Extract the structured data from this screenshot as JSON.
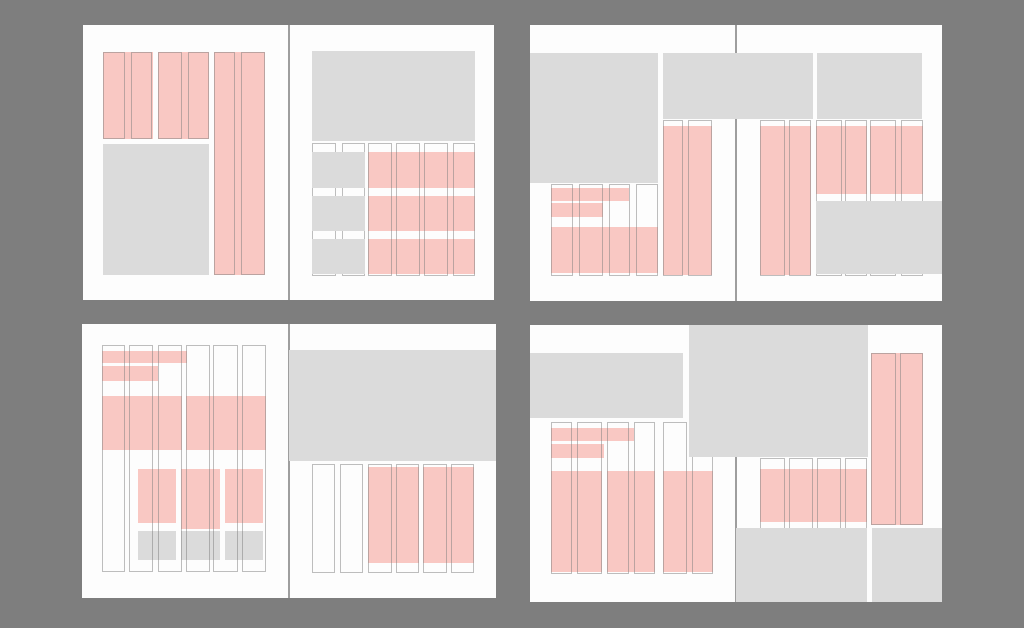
{
  "canvas": {
    "width": 1024,
    "height": 628,
    "background": "#7e7e7e"
  },
  "palette": {
    "page_white": "#fdfdfd",
    "text_block_pink": "#f9c8c3",
    "image_block_gray": "#dbdbdb",
    "column_guide_line": "rgba(125,125,125,0.5)",
    "fold_line_gray": "#7d7d7d"
  },
  "legend": {
    "pink_blocks": "text-column placeholders",
    "gray_blocks": "image placeholders",
    "outlined_columns": "grid column guides"
  },
  "spreads": [
    {
      "name": "spread-top-left",
      "x": 83,
      "y": 25,
      "w": 411,
      "h": 275,
      "fold_x": 205.5,
      "pages": [
        {
          "name": "page-left",
          "x": 0,
          "w": 205.5
        },
        {
          "name": "page-right",
          "x": 205.5,
          "w": 205.5
        }
      ],
      "pinks": [
        {
          "x": 20,
          "y": 26.5,
          "w": 49.5,
          "h": 87.5
        },
        {
          "x": 75,
          "y": 26.5,
          "w": 50.7,
          "h": 87.5
        },
        {
          "x": 130.7,
          "y": 26.5,
          "w": 51.6,
          "h": 223.2
        },
        {
          "x": 285.3,
          "y": 127,
          "w": 106.7,
          "h": 36
        },
        {
          "x": 285.3,
          "y": 171.3,
          "w": 106.7,
          "h": 35
        },
        {
          "x": 285.3,
          "y": 213.7,
          "w": 106.7,
          "h": 35
        }
      ],
      "grays_under": [],
      "guides": [
        {
          "x": 20,
          "y": 26.5,
          "w": 22.3,
          "h": 87.5
        },
        {
          "x": 48.3,
          "y": 26.5,
          "w": 21.2,
          "h": 87.5
        },
        {
          "x": 75,
          "y": 26.5,
          "w": 23.7,
          "h": 87.5
        },
        {
          "x": 104.7,
          "y": 26.5,
          "w": 21,
          "h": 87.5
        },
        {
          "x": 130.7,
          "y": 26.5,
          "w": 21.6,
          "h": 223.2
        },
        {
          "x": 158,
          "y": 26.5,
          "w": 24.3,
          "h": 223.2
        },
        {
          "x": 228.7,
          "y": 118,
          "w": 24.3,
          "h": 133
        },
        {
          "x": 258.7,
          "y": 118,
          "w": 23.3,
          "h": 133
        },
        {
          "x": 285.3,
          "y": 118,
          "w": 23.4,
          "h": 133
        },
        {
          "x": 313,
          "y": 118,
          "w": 24,
          "h": 133
        },
        {
          "x": 341.3,
          "y": 118,
          "w": 24,
          "h": 133
        },
        {
          "x": 369.7,
          "y": 118,
          "w": 22.3,
          "h": 133
        }
      ],
      "grays": [
        {
          "x": 20,
          "y": 119,
          "w": 105.7,
          "h": 130.7
        },
        {
          "x": 228.7,
          "y": 26.3,
          "w": 163.3,
          "h": 90
        },
        {
          "x": 228.7,
          "y": 127,
          "w": 53.3,
          "h": 36
        },
        {
          "x": 228.7,
          "y": 171.3,
          "w": 53.3,
          "h": 35
        },
        {
          "x": 228.7,
          "y": 213.7,
          "w": 53.3,
          "h": 35
        }
      ]
    },
    {
      "name": "spread-top-right",
      "x": 530,
      "y": 25,
      "w": 412,
      "h": 276,
      "fold_x": 206.3,
      "pages": [
        {
          "name": "page-left",
          "x": 0,
          "w": 206.3
        },
        {
          "name": "page-right",
          "x": 206.3,
          "w": 205.7
        }
      ],
      "pinks": [
        {
          "x": 21,
          "y": 163.3,
          "w": 78,
          "h": 12.7
        },
        {
          "x": 21,
          "y": 178.3,
          "w": 51.7,
          "h": 13.4
        },
        {
          "x": 21,
          "y": 201.7,
          "w": 107,
          "h": 46.6
        },
        {
          "x": 132.7,
          "y": 100.7,
          "w": 49,
          "h": 149
        },
        {
          "x": 230,
          "y": 100.7,
          "w": 51,
          "h": 149
        },
        {
          "x": 286,
          "y": 100.7,
          "w": 50.7,
          "h": 68
        },
        {
          "x": 340,
          "y": 100.7,
          "w": 53.3,
          "h": 68
        }
      ],
      "grays_under": [],
      "guides": [
        {
          "x": 21,
          "y": 158.5,
          "w": 22.3,
          "h": 92.5
        },
        {
          "x": 49.3,
          "y": 158.5,
          "w": 23.4,
          "h": 92.5
        },
        {
          "x": 79,
          "y": 158.5,
          "w": 21.3,
          "h": 92.5
        },
        {
          "x": 106,
          "y": 158.5,
          "w": 22,
          "h": 92.5
        },
        {
          "x": 132.7,
          "y": 95,
          "w": 20,
          "h": 155.5
        },
        {
          "x": 158.3,
          "y": 95,
          "w": 23.4,
          "h": 155.5
        },
        {
          "x": 230,
          "y": 95,
          "w": 25,
          "h": 155.5
        },
        {
          "x": 259.3,
          "y": 95,
          "w": 21.7,
          "h": 155.5
        },
        {
          "x": 286,
          "y": 95,
          "w": 25.7,
          "h": 155.5
        },
        {
          "x": 315,
          "y": 95,
          "w": 21.7,
          "h": 155.5
        },
        {
          "x": 340,
          "y": 95,
          "w": 26,
          "h": 155.5
        },
        {
          "x": 370.7,
          "y": 95,
          "w": 22.6,
          "h": 155.5
        }
      ],
      "grays": [
        {
          "x": 0,
          "y": 27.7,
          "w": 128,
          "h": 130.6
        },
        {
          "x": 132.7,
          "y": 27.7,
          "w": 150,
          "h": 66.6
        },
        {
          "x": 286.7,
          "y": 27.7,
          "w": 105.6,
          "h": 66.6
        },
        {
          "x": 286,
          "y": 176,
          "w": 126,
          "h": 73.3
        }
      ]
    },
    {
      "name": "spread-bottom-left",
      "x": 82,
      "y": 324,
      "w": 414,
      "h": 274,
      "fold_x": 206.5,
      "pages": [
        {
          "name": "page-left",
          "x": 0,
          "w": 206.5
        },
        {
          "name": "page-right",
          "x": 206.5,
          "w": 207.5
        }
      ],
      "pinks": [
        {
          "x": 20.3,
          "y": 26.7,
          "w": 84.4,
          "h": 12.6
        },
        {
          "x": 20.3,
          "y": 42,
          "w": 56,
          "h": 14.7
        },
        {
          "x": 20.3,
          "y": 72,
          "w": 79.4,
          "h": 54
        },
        {
          "x": 104,
          "y": 72,
          "w": 79.7,
          "h": 54
        },
        {
          "x": 56,
          "y": 144.5,
          "w": 38,
          "h": 54.5
        },
        {
          "x": 99,
          "y": 144.5,
          "w": 38.5,
          "h": 60
        },
        {
          "x": 143,
          "y": 144.5,
          "w": 38.3,
          "h": 54.5
        },
        {
          "x": 286.3,
          "y": 143.3,
          "w": 51,
          "h": 95.4
        },
        {
          "x": 341.3,
          "y": 143.3,
          "w": 51,
          "h": 95.4
        }
      ],
      "grays_under": [
        {
          "x": 56,
          "y": 207,
          "w": 38,
          "h": 29
        },
        {
          "x": 99,
          "y": 207,
          "w": 38.5,
          "h": 29
        },
        {
          "x": 143,
          "y": 207,
          "w": 38.3,
          "h": 29
        }
      ],
      "guides": [
        {
          "x": 20.3,
          "y": 21,
          "w": 22.7,
          "h": 227
        },
        {
          "x": 47.3,
          "y": 21,
          "w": 24,
          "h": 227
        },
        {
          "x": 75.7,
          "y": 21,
          "w": 24,
          "h": 227
        },
        {
          "x": 104,
          "y": 21,
          "w": 24,
          "h": 227
        },
        {
          "x": 131.3,
          "y": 21,
          "w": 24.4,
          "h": 227
        },
        {
          "x": 159.7,
          "y": 21,
          "w": 24,
          "h": 227
        },
        {
          "x": 229.7,
          "y": 140,
          "w": 23.3,
          "h": 109.3
        },
        {
          "x": 258,
          "y": 140,
          "w": 23.3,
          "h": 109.3
        },
        {
          "x": 286.3,
          "y": 140,
          "w": 23.4,
          "h": 109.3
        },
        {
          "x": 314,
          "y": 140,
          "w": 23.3,
          "h": 109.3
        },
        {
          "x": 341.3,
          "y": 140,
          "w": 23.4,
          "h": 109.3
        },
        {
          "x": 369,
          "y": 140,
          "w": 23.3,
          "h": 109.3
        }
      ],
      "grays": [
        {
          "x": 206.5,
          "y": 26,
          "w": 207.5,
          "h": 110.7
        }
      ]
    },
    {
      "name": "spread-bottom-right",
      "x": 530,
      "y": 325,
      "w": 412,
      "h": 277,
      "fold_x": 206,
      "pages": [
        {
          "name": "page-left",
          "x": 0,
          "w": 206
        },
        {
          "name": "page-right",
          "x": 206,
          "w": 206
        }
      ],
      "pinks": [
        {
          "x": 21,
          "y": 103.3,
          "w": 83.3,
          "h": 12.7
        },
        {
          "x": 21,
          "y": 119.3,
          "w": 53.3,
          "h": 13.4
        },
        {
          "x": 21,
          "y": 145.7,
          "w": 50.7,
          "h": 101
        },
        {
          "x": 76.7,
          "y": 145.7,
          "w": 48.3,
          "h": 101
        },
        {
          "x": 132.7,
          "y": 145.7,
          "w": 50,
          "h": 101
        },
        {
          "x": 230,
          "y": 144.3,
          "w": 106.7,
          "h": 52.4
        },
        {
          "x": 341,
          "y": 27.7,
          "w": 51.7,
          "h": 172.3
        }
      ],
      "grays_under": [],
      "guides": [
        {
          "x": 21,
          "y": 96.7,
          "w": 20.7,
          "h": 152.3
        },
        {
          "x": 46.7,
          "y": 96.7,
          "w": 25,
          "h": 152.3
        },
        {
          "x": 76.7,
          "y": 96.7,
          "w": 22.6,
          "h": 152.3
        },
        {
          "x": 104.3,
          "y": 96.7,
          "w": 20.7,
          "h": 152.3
        },
        {
          "x": 132.7,
          "y": 96.7,
          "w": 24,
          "h": 152.3
        },
        {
          "x": 161.7,
          "y": 96.7,
          "w": 21,
          "h": 152.3
        },
        {
          "x": 230,
          "y": 133,
          "w": 25,
          "h": 116
        },
        {
          "x": 259.3,
          "y": 133,
          "w": 24,
          "h": 116
        },
        {
          "x": 287.3,
          "y": 133,
          "w": 23.7,
          "h": 116
        },
        {
          "x": 315,
          "y": 133,
          "w": 21.7,
          "h": 116
        },
        {
          "x": 341,
          "y": 27.7,
          "w": 25,
          "h": 172.3
        },
        {
          "x": 370,
          "y": 27.7,
          "w": 22.7,
          "h": 172.3
        }
      ],
      "grays": [
        {
          "x": 0,
          "y": 27.7,
          "w": 153.3,
          "h": 65.6
        },
        {
          "x": 159.3,
          "y": 0,
          "w": 179,
          "h": 132.3
        },
        {
          "x": 206,
          "y": 203.3,
          "w": 130.5,
          "h": 73.7
        },
        {
          "x": 341.5,
          "y": 203.3,
          "w": 70.5,
          "h": 73.7
        }
      ]
    }
  ]
}
